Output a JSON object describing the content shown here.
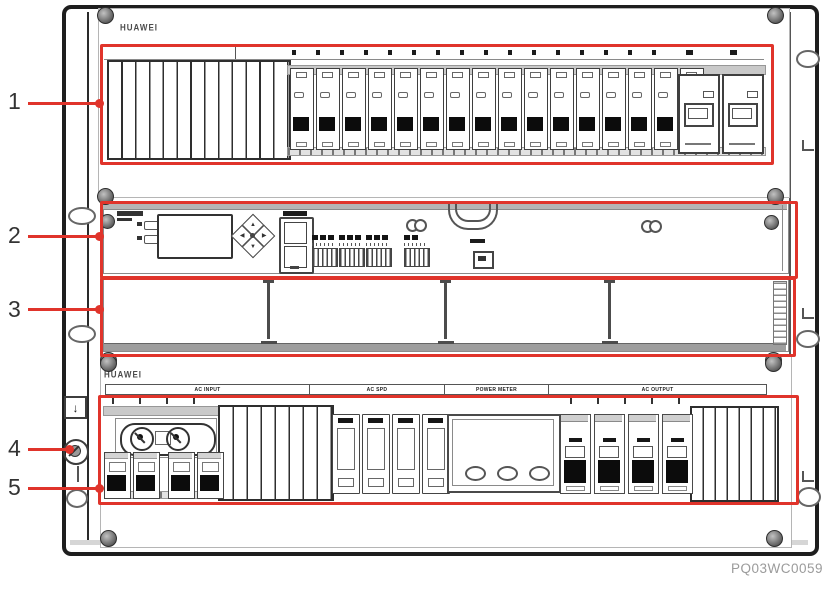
{
  "figure_code": "PQ03WC0059",
  "brand": "HUAWEI",
  "callouts": [
    {
      "label": "1"
    },
    {
      "label": "2"
    },
    {
      "label": "3"
    },
    {
      "label": "4"
    },
    {
      "label": "5"
    }
  ],
  "top_unit": {
    "logo": "HUAWEI",
    "blank_fin_count": 13,
    "breaker_count": 16,
    "fuse_unit_count": 2
  },
  "monitoring_unit": {
    "led_count": 2,
    "terminal_group_count": 3,
    "meter_port_circle_count": 2
  },
  "empty_row": {
    "slot_divider_count": 3
  },
  "bottom_unit": {
    "logo": "HUAWEI",
    "section_labels": [
      "AC INPUT",
      "AC SPD",
      "POWER METER",
      "AC OUTPUT"
    ],
    "input_breaker_count": 4,
    "spd_module_count": 4,
    "meter_button_count": 3,
    "output_breaker_count": 4,
    "left_fin_count": 8,
    "right_fin_count": 7
  },
  "colors": {
    "callout_red": "#e0342b",
    "line_dark": "#2a2a2a",
    "figure_code_gray": "#9b9b9b"
  },
  "icons": {
    "ground_arrow": "↓"
  }
}
